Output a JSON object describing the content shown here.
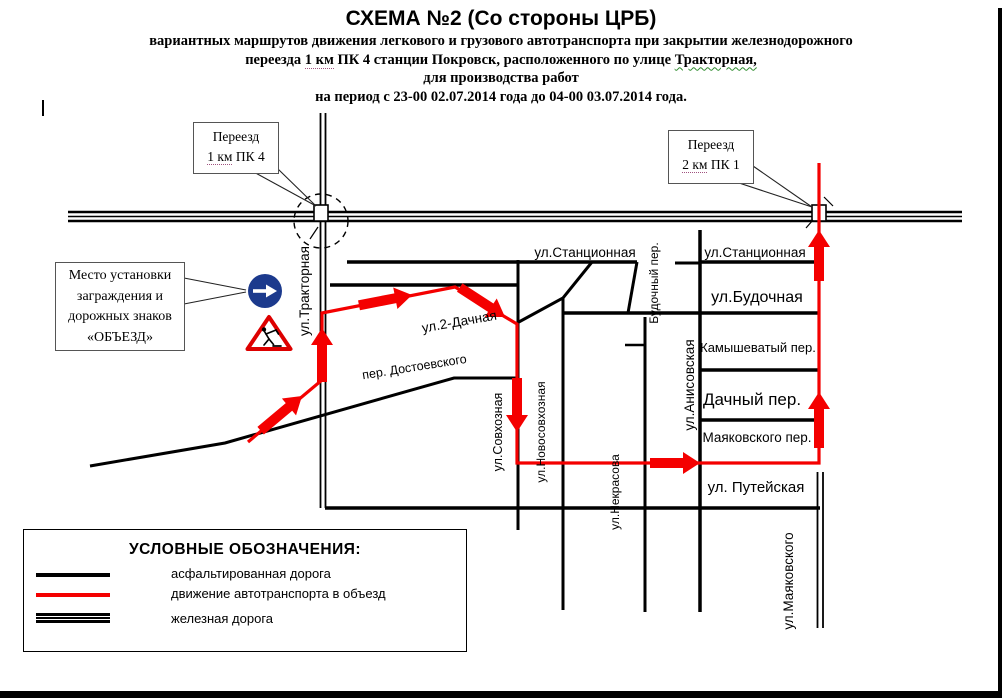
{
  "title": {
    "line1": "СХЕМА №2 (Со стороны ЦРБ)",
    "line2": "вариантных маршрутов движения легкового и грузового автотранспорта при закрытии железнодорожного",
    "line3_pre": "переезда ",
    "line3_u1": "1 км",
    "line3_mid": " ПК 4 станции Покровск, расположенного по улице ",
    "line3_u2": "Тракторная,",
    "line4": "для производства работ",
    "line5": "на период с 23-00 02.07.2014 года до 04-00 03.07.2014 года."
  },
  "callouts": {
    "crossing1": {
      "line1": "Переезд",
      "line2_u": "1 км",
      "line2_rest": " ПК 4"
    },
    "crossing2": {
      "line1": "Переезд",
      "line2_u": "2 км",
      "line2_rest": " ПК 1"
    },
    "barrier": {
      "line1": "Место установки",
      "line2": "заграждения и",
      "line3": "дорожных знаков",
      "line4": "«ОБЪЕЗД»"
    }
  },
  "streets": {
    "stantsionnaya_left": "ул.Станционная",
    "stantsionnaya_right": "ул.Станционная",
    "budochnaya": "ул.Будочная",
    "kamyshevatyy": "Камышеватый пер.",
    "dachnyy_per": "Дачный пер.",
    "mayakovskogo_per": "Маяковского пер.",
    "puteyskaya": "ул. Путейская",
    "traktornaya": "ул.Тракторная",
    "dachnaya_2": "ул.2-Дачная",
    "dostoevskogo": "пер. Достоевского",
    "sovkhoznaya": "ул.Совхозная",
    "novosovkhoznaya": "ул.Новосовхозная",
    "nekrasova": "ул.Некрасова",
    "budochnyy_per": "Будочный пер.",
    "anisovskaya": "ул.Анисовская",
    "mayakovskogo_ul": "ул.Маяковского"
  },
  "legend": {
    "title": "УСЛОВНЫЕ ОБОЗНАЧЕНИЯ:",
    "items": [
      {
        "label": "асфальтированная дорога",
        "swatch": "black-line"
      },
      {
        "label": "движение автотранспорта в объезд",
        "swatch": "red-line"
      },
      {
        "label": "железная дорога",
        "swatch": "double-black-line"
      }
    ]
  },
  "colors": {
    "route_red": "#f40000",
    "road_black": "#000000",
    "sign_blue": "#1c3a8d",
    "sign_triangle_red": "#dd0000"
  }
}
